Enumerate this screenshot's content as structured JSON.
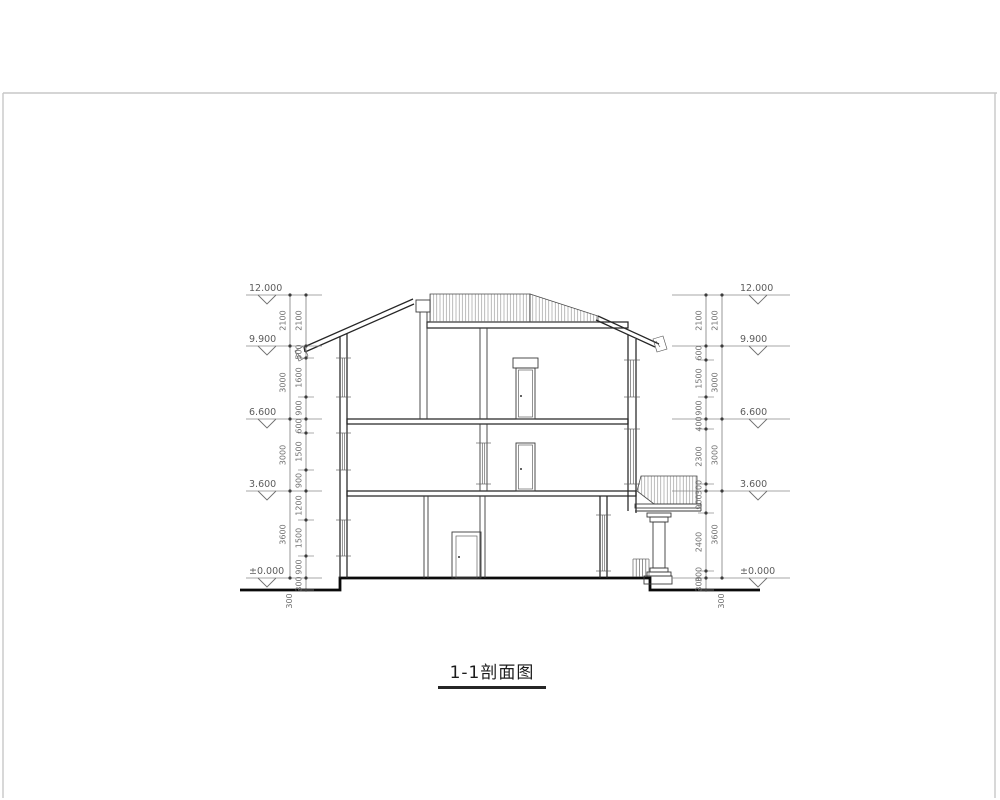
{
  "drawing_title": "1-1剖面图",
  "colors": {
    "line": "#262626",
    "dimension": "#7d7d7d",
    "ground": "#0a0a0a",
    "hatch": "#8a8a8a",
    "page_frame": "#c7c7c7"
  },
  "elevations": {
    "levels": [
      {
        "label": "12.000",
        "y": 295
      },
      {
        "label": "9.900",
        "y": 346
      },
      {
        "label": "6.600",
        "y": 419
      },
      {
        "label": "3.600",
        "y": 491
      },
      {
        "label": "±0.000",
        "y": 578
      }
    ]
  },
  "dimensions": {
    "sides": [
      {
        "name": "left",
        "inner_x": 306,
        "outer_x": 290,
        "ext_minor": [
          298,
          314
        ],
        "ext_major": [
          246,
          322
        ],
        "marker": {
          "text_x": 249,
          "tri_cx": 267
        },
        "outer": [
          {
            "value": "2100",
            "y1": 295,
            "y2": 346
          },
          {
            "value": "3000",
            "y1": 346,
            "y2": 419
          },
          {
            "value": "3000",
            "y1": 419,
            "y2": 491
          },
          {
            "value": "3600",
            "y1": 491,
            "y2": 578
          }
        ],
        "inner": [
          {
            "value": "2100",
            "y1": 295,
            "y2": 346
          },
          {
            "value": "500",
            "y1": 346,
            "y2": 358
          },
          {
            "value": "1600",
            "y1": 358,
            "y2": 397
          },
          {
            "value": "900",
            "y1": 397,
            "y2": 419
          },
          {
            "value": "600",
            "y1": 419,
            "y2": 433
          },
          {
            "value": "1500",
            "y1": 433,
            "y2": 470
          },
          {
            "value": "900",
            "y1": 470,
            "y2": 491
          },
          {
            "value": "1200",
            "y1": 491,
            "y2": 520
          },
          {
            "value": "1500",
            "y1": 520,
            "y2": 556
          },
          {
            "value": "900",
            "y1": 556,
            "y2": 578
          },
          {
            "value": "300",
            "y1": 578,
            "y2": 590
          }
        ],
        "below_grade_label": {
          "value": "300",
          "x": 292,
          "y": 601
        }
      },
      {
        "name": "right",
        "inner_x": 706,
        "outer_x": 722,
        "ext_minor": [
          698,
          714
        ],
        "ext_major": [
          672,
          790
        ],
        "marker": {
          "text_x": 740,
          "tri_cx": 758
        },
        "outer": [
          {
            "value": "2100",
            "y1": 295,
            "y2": 346
          },
          {
            "value": "3000",
            "y1": 346,
            "y2": 419
          },
          {
            "value": "3000",
            "y1": 419,
            "y2": 491
          },
          {
            "value": "3600",
            "y1": 491,
            "y2": 578
          }
        ],
        "inner": [
          {
            "value": "2100",
            "y1": 295,
            "y2": 346
          },
          {
            "value": "600",
            "y1": 346,
            "y2": 360
          },
          {
            "value": "1500",
            "y1": 360,
            "y2": 397
          },
          {
            "value": "900",
            "y1": 397,
            "y2": 419
          },
          {
            "value": "400",
            "y1": 419,
            "y2": 429
          },
          {
            "value": "2300",
            "y1": 429,
            "y2": 484
          },
          {
            "value": "300",
            "y1": 484,
            "y2": 491
          },
          {
            "value": "900",
            "y1": 491,
            "y2": 513
          },
          {
            "value": "2400",
            "y1": 513,
            "y2": 571
          },
          {
            "value": "300",
            "y1": 571,
            "y2": 578
          },
          {
            "value": "300",
            "y1": 578,
            "y2": 590
          }
        ],
        "below_grade_label": {
          "value": "300",
          "x": 724,
          "y": 601
        }
      }
    ]
  }
}
